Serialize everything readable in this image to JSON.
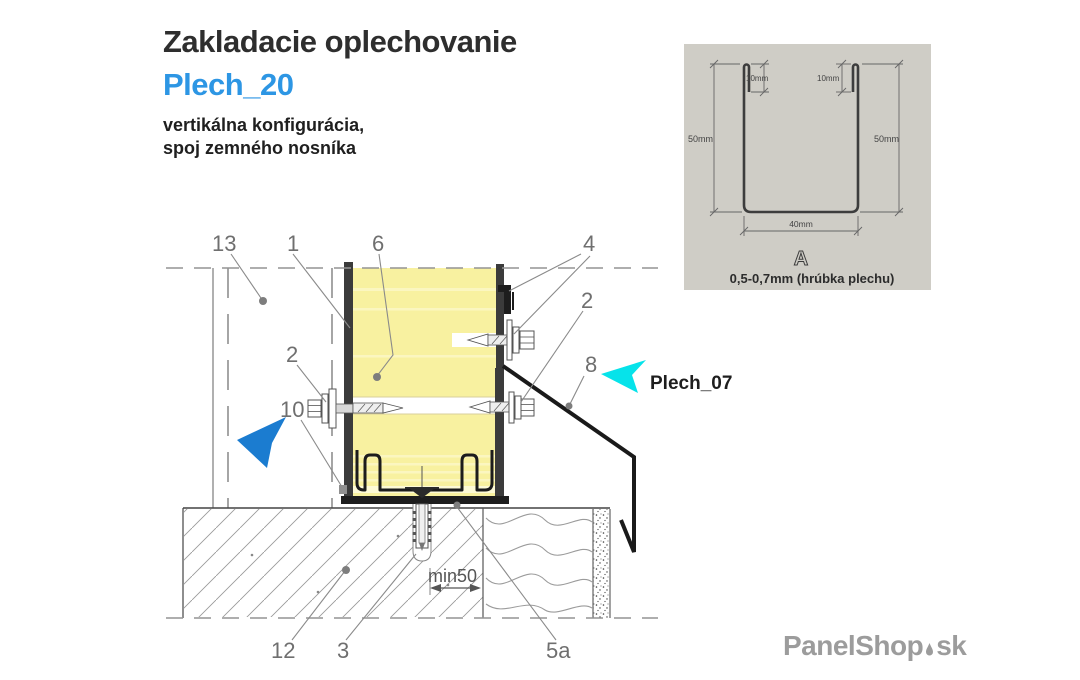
{
  "header": {
    "title": "Zakladacie oplechovanie",
    "product_code": "Plech_20",
    "subtitle_line1": "vertikálna konfigurácia,",
    "subtitle_line2": "spoj zemného nosníka"
  },
  "inset": {
    "dim_lip_left": "10mm",
    "dim_lip_right": "10mm",
    "dim_height_left": "50mm",
    "dim_height_right": "50mm",
    "dim_width": "40mm",
    "section_letter": "A",
    "thickness_note": "0,5-0,7mm (hrúbka plechu)"
  },
  "drawing": {
    "callouts": {
      "n13": "13",
      "n1": "1",
      "n6": "6",
      "n4": "4",
      "n2_right": "2",
      "n2_left": "2",
      "n8": "8",
      "n10": "10",
      "n12": "12",
      "n3": "3",
      "n5a": "5a"
    },
    "dimension_min50": "min50",
    "flashing_label": "Plech_07"
  },
  "watermark": {
    "brand": "PanelShop",
    "tld": "sk"
  },
  "colors": {
    "accent_blue": "#2d96e4",
    "pointer_blue": "#1b7cd0",
    "pointer_cyan": "#06e3ea",
    "panel_yellow": "#f8f1a0",
    "inset_background": "#cfcdc6",
    "line_gray": "#8a8a8a",
    "profile_dark": "#1d1d1d",
    "logo_gray": "#9c9c9c"
  }
}
